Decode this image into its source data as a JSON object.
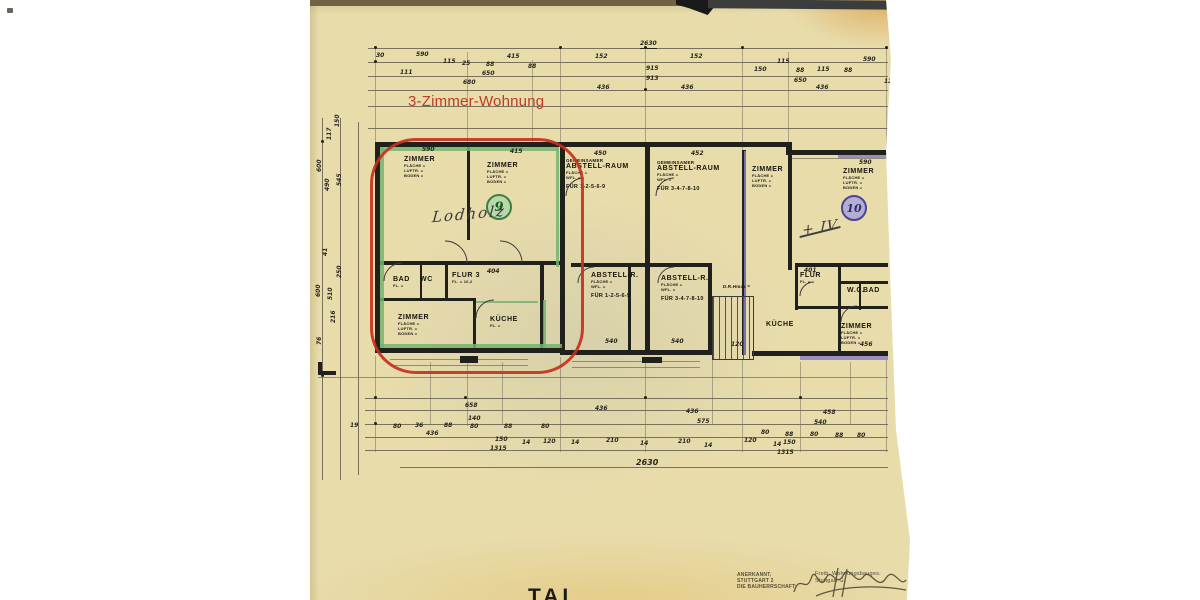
{
  "scan": {
    "highlight_label": "3-Zimmer-Wohnung",
    "partial_title": "TAL",
    "unit_circles": [
      {
        "id": "unit-9",
        "label": "9"
      },
      {
        "id": "unit-10",
        "label": "10"
      }
    ],
    "handwriting": [
      {
        "id": "owner-name-unit-9",
        "text": "Lodholz"
      },
      {
        "id": "mark-unit-10",
        "text": "+ IV"
      }
    ],
    "stamp": {
      "left_lines": [
        "ANERKANNT,",
        "STUTTGART 2",
        "DIE BAUHERRSCHAFT:"
      ],
      "right_lines": [
        "Freib. Wohnungsbauges.",
        "Stuttgart G"
      ]
    },
    "colors": {
      "paper": "#e8dcab",
      "ink": "#20201c",
      "highlight_red": "#c5311d",
      "unit9_green": "#76b46e",
      "unit10_purple": "#8880c4"
    },
    "rooms": [
      {
        "n": "zimmer-9-nw",
        "x": 94,
        "y": 156,
        "title": "ZIMMER",
        "subs": [
          "FLÄCHE =",
          "LUFTR. =",
          "BODEN ="
        ]
      },
      {
        "n": "zimmer-9-ne",
        "x": 177,
        "y": 162,
        "title": "ZIMMER",
        "subs": [
          "FLÄCHE =",
          "LUFTR. =",
          "BODEN ="
        ]
      },
      {
        "n": "abstell-raum-1",
        "x": 256,
        "y": 158,
        "pre": "GEMEINSAMER",
        "title": "ABSTELL-RAUM",
        "subs": [
          "FLÄCHE =",
          "WFL. ="
        ],
        "fur": "FÜR 1-2-5-6-9"
      },
      {
        "n": "abstell-raum-2",
        "x": 347,
        "y": 160,
        "pre": "GEMEINSAMER",
        "title": "ABSTELL-RAUM",
        "subs": [
          "FLÄCHE =",
          "WFL. ="
        ],
        "fur": "FÜR 3-4-7-8-10"
      },
      {
        "n": "zimmer-mid",
        "x": 442,
        "y": 166,
        "title": "ZIMMER",
        "subs": [
          "FLÄCHE =",
          "LUFTR. =",
          "BODEN ="
        ]
      },
      {
        "n": "zimmer-10",
        "x": 533,
        "y": 168,
        "title": "ZIMMER",
        "subs": [
          "FLÄCHE =",
          "LUFTR. =",
          "BODEN ="
        ]
      },
      {
        "n": "bad-9",
        "x": 83,
        "y": 276,
        "title": "BAD",
        "subs": [
          "FL. ="
        ]
      },
      {
        "n": "wc-9",
        "x": 110,
        "y": 276,
        "title": "WC",
        "subs": []
      },
      {
        "n": "flur-9",
        "x": 142,
        "y": 272,
        "title": "FLUR 3",
        "subs": [
          "FL. = 10,2"
        ]
      },
      {
        "n": "zimmer-9-s",
        "x": 88,
        "y": 314,
        "title": "ZIMMER",
        "subs": [
          "FLÄCHE =",
          "LUFTR. =",
          "BODEN ="
        ]
      },
      {
        "n": "kueche-9",
        "x": 180,
        "y": 316,
        "title": "KÜCHE",
        "subs": [
          "FL. ="
        ]
      },
      {
        "n": "abstell-r-1",
        "x": 281,
        "y": 272,
        "title": "ABSTELL-R.",
        "subs": [
          "FLÄCHE =",
          "WFL. ="
        ],
        "fur": "FÜR 1-2-5-6-9"
      },
      {
        "n": "abstell-r-2",
        "x": 351,
        "y": 275,
        "title": "ABSTELL-R.",
        "subs": [
          "FLÄCHE =",
          "WFL. ="
        ],
        "fur": "FÜR 3-4-7-8-10"
      },
      {
        "n": "drh-note",
        "x": 413,
        "y": 283,
        "title": "D.R.Hmax =",
        "subs": [],
        "small": 1
      },
      {
        "n": "flur-10",
        "x": 490,
        "y": 272,
        "title": "FLUR",
        "subs": [
          "FL. ="
        ]
      },
      {
        "n": "wc-10",
        "x": 537,
        "y": 287,
        "title": "W.C.",
        "subs": []
      },
      {
        "n": "bad-10",
        "x": 553,
        "y": 287,
        "title": "BAD",
        "subs": []
      },
      {
        "n": "kueche-mid",
        "x": 456,
        "y": 321,
        "title": "KÜCHE",
        "subs": []
      },
      {
        "n": "zimmer-10-s",
        "x": 531,
        "y": 323,
        "title": "ZIMMER",
        "subs": [
          "FLÄCHE =",
          "LUFTR. =",
          "BODEN ="
        ]
      }
    ],
    "dims": [
      {
        "t": "2630",
        "x": 330,
        "y": 40,
        "u": 1
      },
      {
        "t": "30",
        "x": 66,
        "y": 52
      },
      {
        "t": "590",
        "x": 106,
        "y": 51
      },
      {
        "t": "115",
        "x": 133,
        "y": 58
      },
      {
        "t": "25",
        "x": 152,
        "y": 60
      },
      {
        "t": "415",
        "x": 197,
        "y": 53
      },
      {
        "t": "88",
        "x": 176,
        "y": 61
      },
      {
        "t": "650",
        "x": 172,
        "y": 70
      },
      {
        "t": "88",
        "x": 218,
        "y": 63
      },
      {
        "t": "111",
        "x": 90,
        "y": 69
      },
      {
        "t": "680",
        "x": 153,
        "y": 79
      },
      {
        "t": "152",
        "x": 285,
        "y": 53
      },
      {
        "t": "436",
        "x": 287,
        "y": 84
      },
      {
        "t": "915",
        "x": 336,
        "y": 65
      },
      {
        "t": "913",
        "x": 336,
        "y": 75
      },
      {
        "t": "152",
        "x": 380,
        "y": 53
      },
      {
        "t": "436",
        "x": 371,
        "y": 84
      },
      {
        "t": "115",
        "x": 467,
        "y": 58
      },
      {
        "t": "150",
        "x": 444,
        "y": 66
      },
      {
        "t": "650",
        "x": 484,
        "y": 77
      },
      {
        "t": "88",
        "x": 486,
        "y": 67
      },
      {
        "t": "115",
        "x": 507,
        "y": 66
      },
      {
        "t": "88",
        "x": 534,
        "y": 67
      },
      {
        "t": "590",
        "x": 553,
        "y": 56
      },
      {
        "t": "436",
        "x": 506,
        "y": 84
      },
      {
        "t": "12",
        "x": 574,
        "y": 78
      },
      {
        "t": "150",
        "x": 24,
        "y": 127,
        "r": 1
      },
      {
        "t": "117",
        "x": 16,
        "y": 140,
        "r": 1
      },
      {
        "t": "600",
        "x": 6,
        "y": 172,
        "r": 1
      },
      {
        "t": "545",
        "x": 26,
        "y": 186,
        "r": 1
      },
      {
        "t": "490",
        "x": 14,
        "y": 191,
        "r": 1
      },
      {
        "t": "41",
        "x": 12,
        "y": 256,
        "r": 1
      },
      {
        "t": "250",
        "x": 26,
        "y": 278,
        "r": 1
      },
      {
        "t": "600",
        "x": 5,
        "y": 297,
        "r": 1
      },
      {
        "t": "510",
        "x": 17,
        "y": 300,
        "r": 1
      },
      {
        "t": "216",
        "x": 20,
        "y": 323,
        "r": 1
      },
      {
        "t": "76",
        "x": 6,
        "y": 345,
        "r": 1
      },
      {
        "t": "590",
        "x": 112,
        "y": 146
      },
      {
        "t": "415",
        "x": 200,
        "y": 148
      },
      {
        "t": "450",
        "x": 284,
        "y": 150
      },
      {
        "t": "452",
        "x": 381,
        "y": 150
      },
      {
        "t": "590",
        "x": 549,
        "y": 159
      },
      {
        "t": "404",
        "x": 177,
        "y": 268
      },
      {
        "t": "401",
        "x": 494,
        "y": 267
      },
      {
        "t": "540",
        "x": 295,
        "y": 338
      },
      {
        "t": "540",
        "x": 361,
        "y": 338
      },
      {
        "t": "120",
        "x": 421,
        "y": 341
      },
      {
        "t": "456",
        "x": 550,
        "y": 341
      },
      {
        "t": "658",
        "x": 155,
        "y": 402
      },
      {
        "t": "436",
        "x": 285,
        "y": 405
      },
      {
        "t": "140",
        "x": 158,
        "y": 415
      },
      {
        "t": "19",
        "x": 40,
        "y": 422
      },
      {
        "t": "80",
        "x": 83,
        "y": 423
      },
      {
        "t": "36",
        "x": 105,
        "y": 422
      },
      {
        "t": "88",
        "x": 134,
        "y": 422
      },
      {
        "t": "80",
        "x": 160,
        "y": 423
      },
      {
        "t": "88",
        "x": 194,
        "y": 423
      },
      {
        "t": "80",
        "x": 231,
        "y": 423
      },
      {
        "t": "436",
        "x": 116,
        "y": 430
      },
      {
        "t": "150",
        "x": 185,
        "y": 436
      },
      {
        "t": "1315",
        "x": 180,
        "y": 445
      },
      {
        "t": "14",
        "x": 212,
        "y": 439
      },
      {
        "t": "120",
        "x": 233,
        "y": 438
      },
      {
        "t": "14",
        "x": 261,
        "y": 439
      },
      {
        "t": "210",
        "x": 296,
        "y": 437
      },
      {
        "t": "14",
        "x": 330,
        "y": 440
      },
      {
        "t": "210",
        "x": 368,
        "y": 438
      },
      {
        "t": "14",
        "x": 394,
        "y": 442
      },
      {
        "t": "120",
        "x": 434,
        "y": 437
      },
      {
        "t": "14",
        "x": 463,
        "y": 441
      },
      {
        "t": "436",
        "x": 376,
        "y": 408
      },
      {
        "t": "575",
        "x": 387,
        "y": 418
      },
      {
        "t": "458",
        "x": 513,
        "y": 409
      },
      {
        "t": "540",
        "x": 504,
        "y": 419
      },
      {
        "t": "80",
        "x": 451,
        "y": 429
      },
      {
        "t": "88",
        "x": 475,
        "y": 431
      },
      {
        "t": "80",
        "x": 500,
        "y": 431
      },
      {
        "t": "88",
        "x": 525,
        "y": 432
      },
      {
        "t": "80",
        "x": 547,
        "y": 432
      },
      {
        "t": "150",
        "x": 473,
        "y": 439
      },
      {
        "t": "1315",
        "x": 467,
        "y": 449
      },
      {
        "t": "2630",
        "x": 326,
        "y": 458,
        "s": 8
      }
    ]
  }
}
